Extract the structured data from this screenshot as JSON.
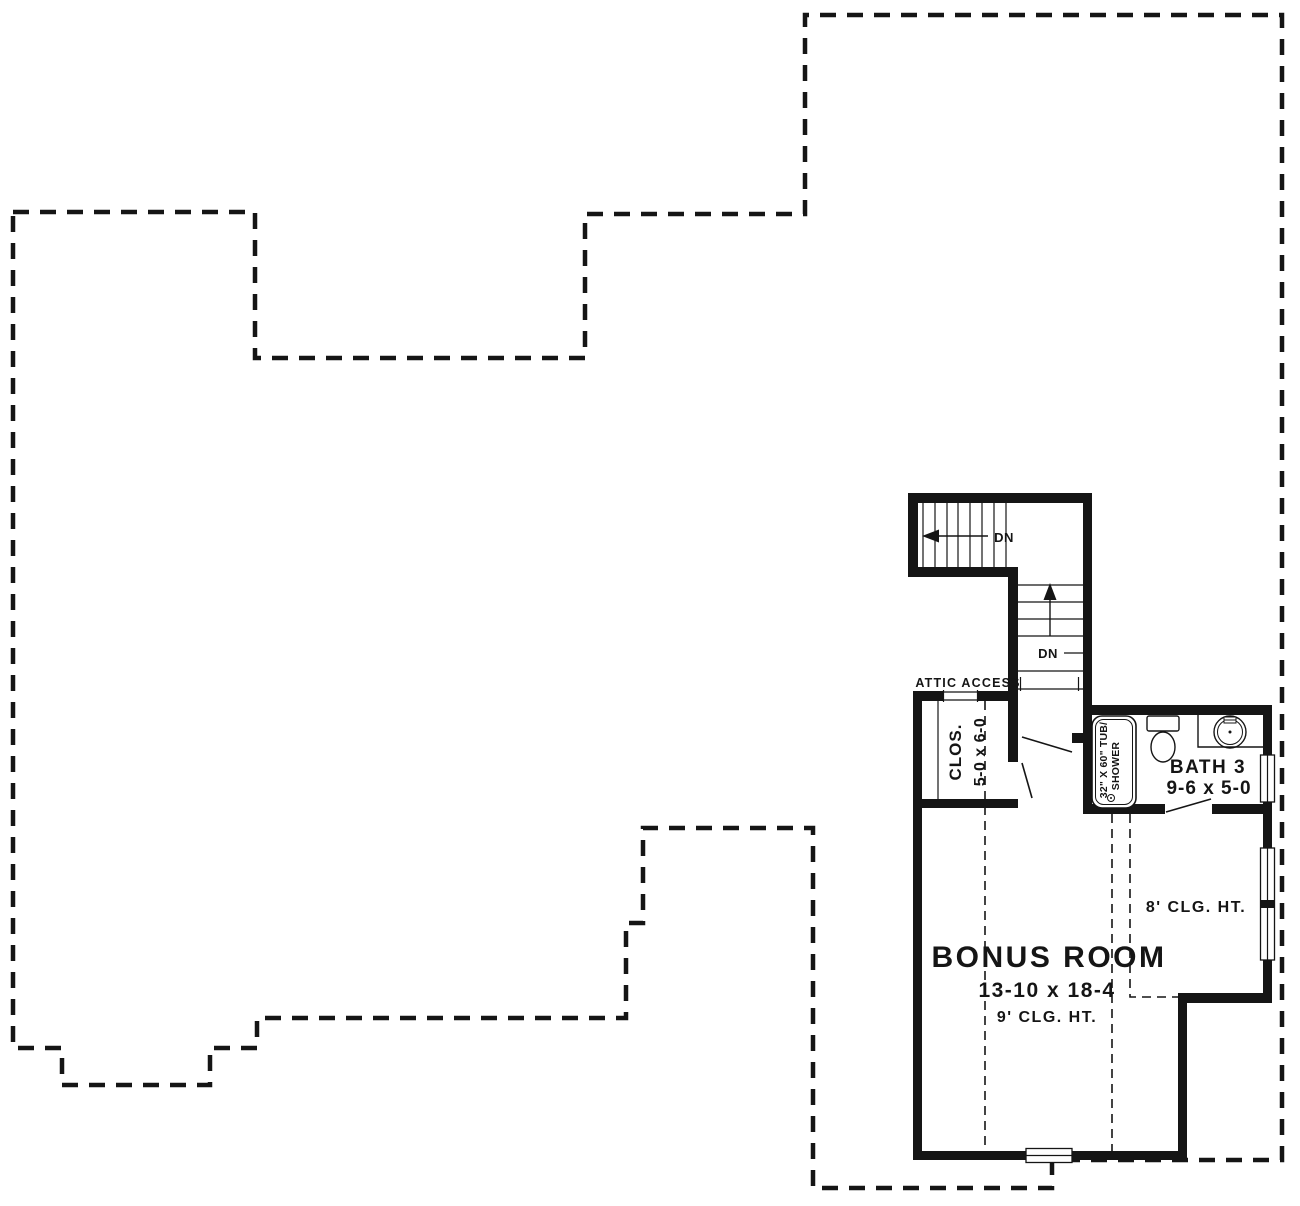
{
  "page": {
    "background": "#ffffff",
    "ink": "#151515"
  },
  "plan": {
    "attic_access_label": "ATTIC ACCESS",
    "stairs": {
      "upper_dn": "DN",
      "lower_dn": "DN"
    },
    "rooms": {
      "closet": {
        "name": "CLOS.",
        "dim": "5-0 x 6-0"
      },
      "bath3": {
        "name": "BATH 3",
        "dim": "9-6 x 5-0"
      },
      "bonus": {
        "name": "BONUS ROOM",
        "dim": "13-10 x 18-4",
        "ceiling": "9' CLG. HT."
      }
    },
    "annotations": {
      "eight_ft_ceiling": "8' CLG. HT."
    },
    "fixtures": {
      "tub_line1": "32\" X 60\" TUB/",
      "tub_line2": "SHOWER"
    }
  }
}
